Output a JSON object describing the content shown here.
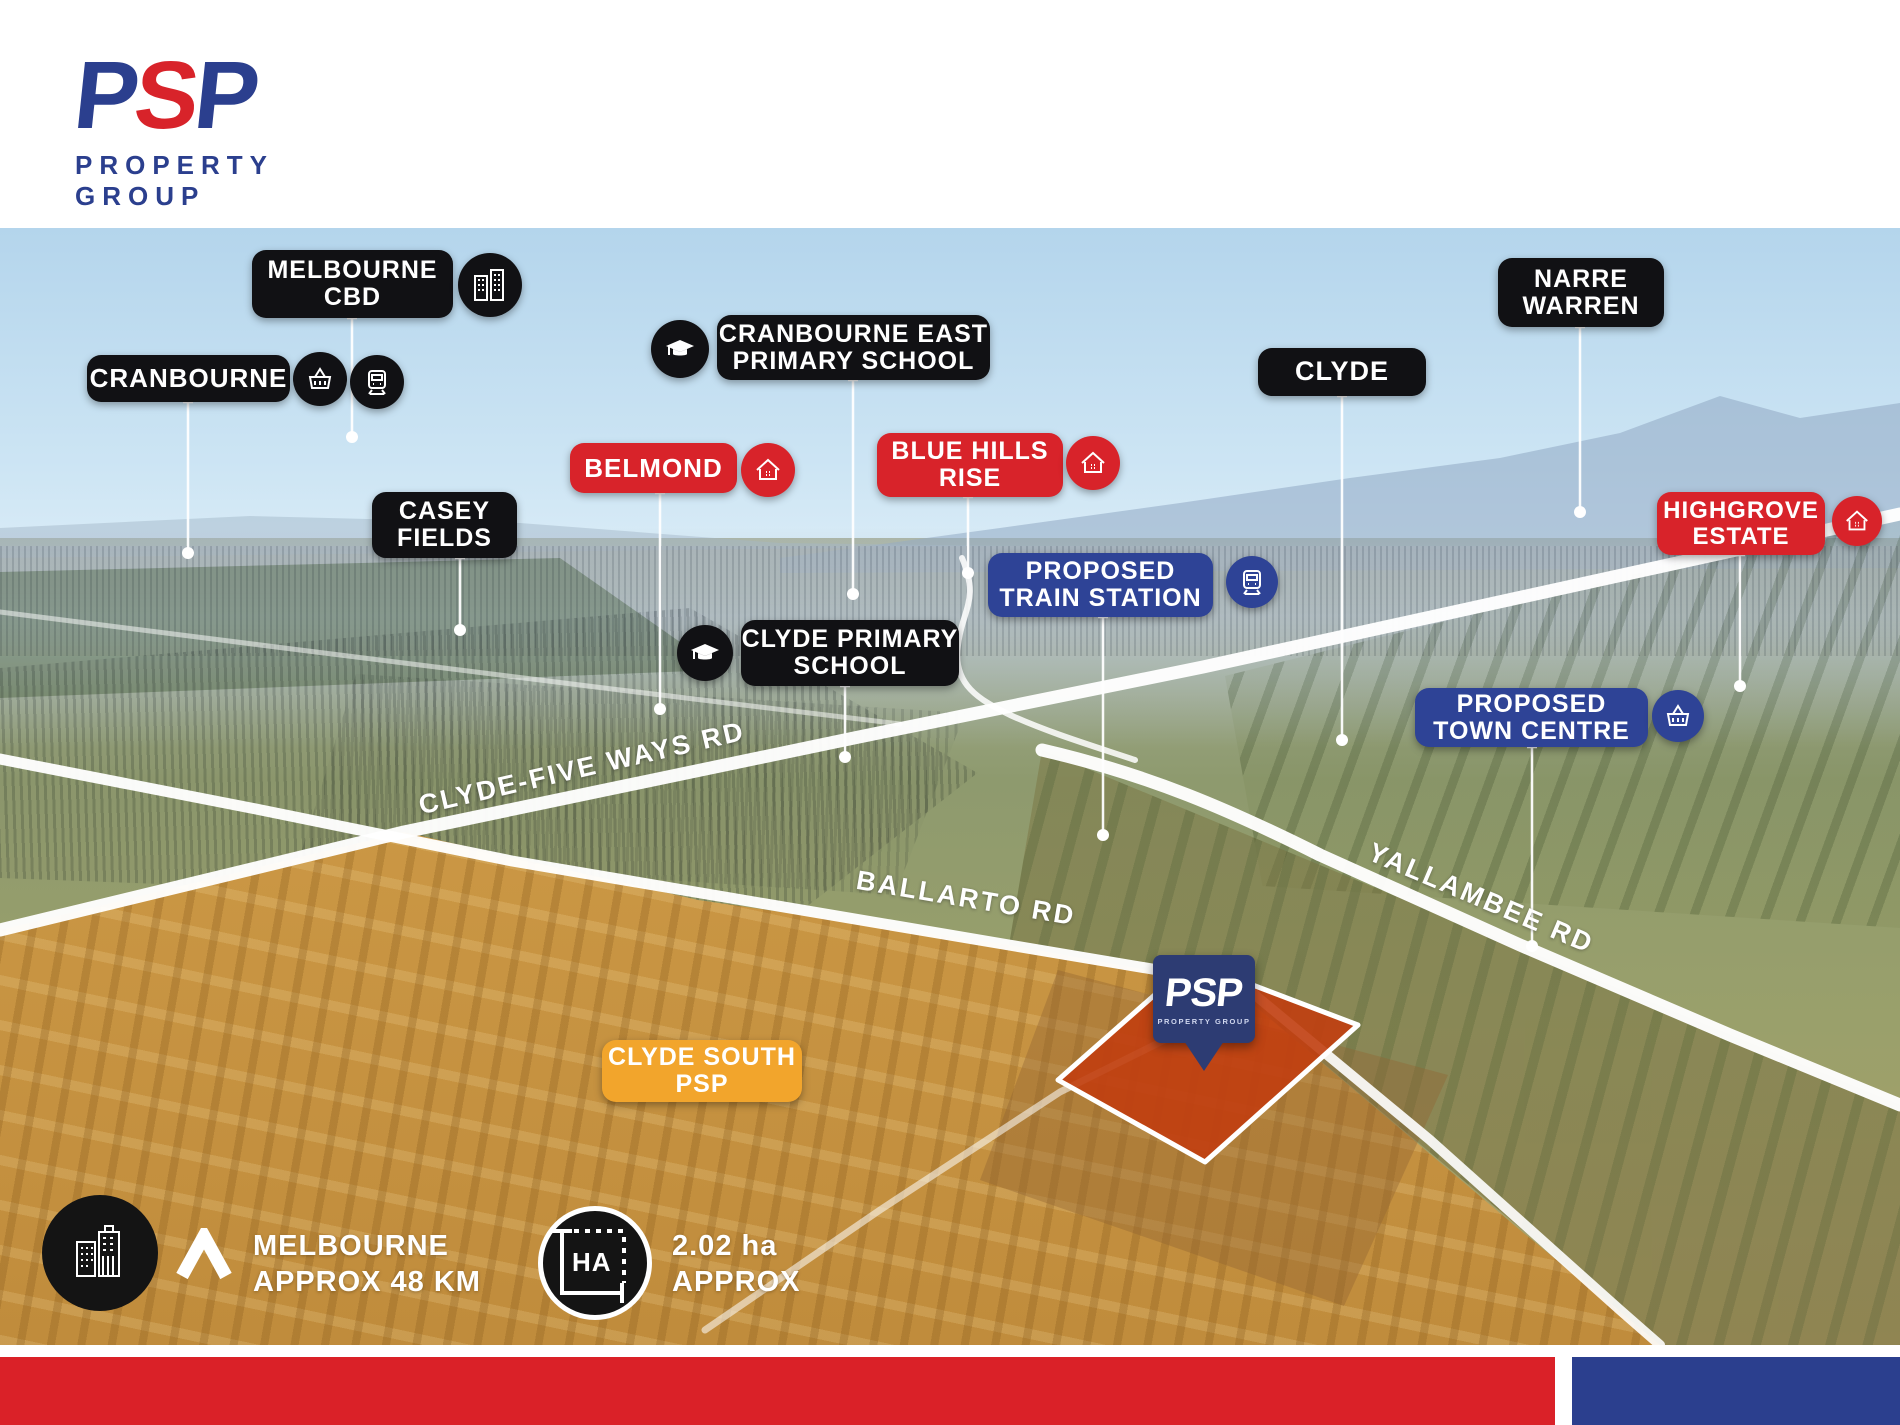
{
  "logo": {
    "p1": "P",
    "s": "S",
    "p2": "P",
    "wordmark": "PROPERTY GROUP"
  },
  "map_labels": {
    "melbourne_cbd": {
      "line1": "MELBOURNE",
      "line2": "CBD",
      "type": "black",
      "icon": "city-buildings"
    },
    "cranbourne": {
      "line1": "CRANBOURNE",
      "type": "black",
      "icons": [
        "shopping-basket",
        "train"
      ]
    },
    "cranbourne_east_ps": {
      "line1": "CRANBOURNE EAST",
      "line2": "PRIMARY SCHOOL",
      "type": "black",
      "icon": "graduation-cap"
    },
    "casey_fields": {
      "line1": "CASEY",
      "line2": "FIELDS",
      "type": "black"
    },
    "belmond": {
      "line1": "BELMOND",
      "type": "red",
      "icon": "home"
    },
    "blue_hills_rise": {
      "line1": "BLUE HILLS",
      "line2": "RISE",
      "type": "red",
      "icon": "home"
    },
    "clyde": {
      "line1": "CLYDE",
      "type": "black"
    },
    "narre_warren": {
      "line1": "NARRE",
      "line2": "WARREN",
      "type": "black"
    },
    "highgrove_estate": {
      "line1": "HIGHGROVE",
      "line2": "ESTATE",
      "type": "red",
      "icon": "home"
    },
    "proposed_train_station": {
      "line1": "PROPOSED",
      "line2": "TRAIN STATION",
      "type": "blue",
      "icon": "train"
    },
    "proposed_town_centre": {
      "line1": "PROPOSED",
      "line2": "TOWN CENTRE",
      "type": "blue",
      "icon": "shopping-basket"
    },
    "clyde_primary_school": {
      "line1": "CLYDE PRIMARY",
      "line2": "SCHOOL",
      "type": "black",
      "icon": "graduation-cap"
    },
    "clyde_south_psp": {
      "line1": "CLYDE SOUTH",
      "line2": "PSP",
      "type": "yellow"
    }
  },
  "road_labels": {
    "clyde_five_ways": "CLYDE-FIVE WAYS RD",
    "ballarto": "BALLARTO RD",
    "yallambee": "YALLAMBEE RD"
  },
  "pin": {
    "brand": "PSP",
    "sub": "PROPERTY GROUP"
  },
  "badges": {
    "distance": {
      "line1": "MELBOURNE",
      "line2": "APPROX 48 KM",
      "icon": "city-buildings"
    },
    "area": {
      "line1": "2.02 ha",
      "line2": "APPROX",
      "icon_text": "HA"
    }
  },
  "colors": {
    "pill_black": "#111114",
    "pill_red": "#d8232a",
    "pill_blue": "#2e4396",
    "pill_yellow": "#f2a52c",
    "pin_navy": "#2d3c73",
    "footer_red": "#da2128",
    "footer_blue": "#2b3f8e",
    "logo_blue": "#2b3f8e",
    "logo_red": "#d8232a",
    "parcel_orange": "#c13e0f"
  }
}
